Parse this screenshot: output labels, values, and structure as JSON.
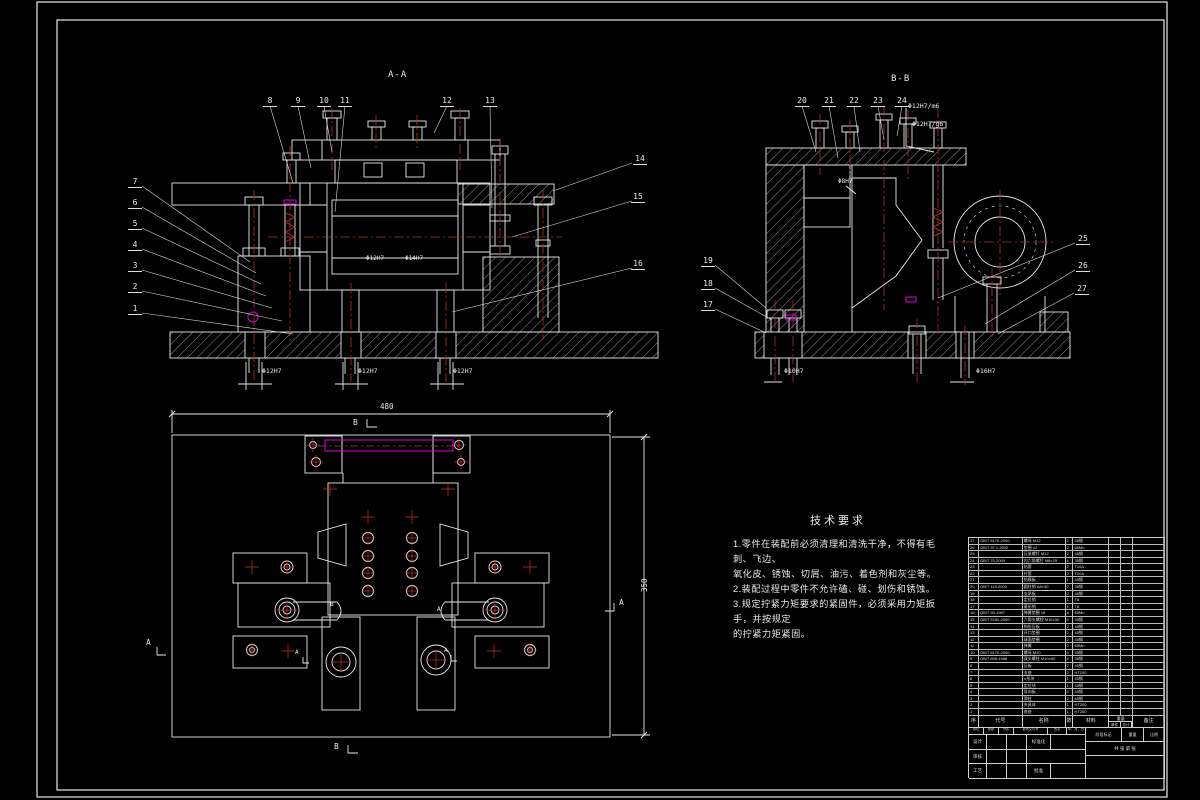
{
  "page": {
    "bg": "#000000",
    "line": "#e8e8e8",
    "centerline_red": "#b03030",
    "highlight_magenta": "#dd00dd"
  },
  "drawing": {
    "section_labels": {
      "front": "A-A",
      "side": "B-B"
    },
    "callouts": {
      "front_top": [
        "8",
        "9",
        "10",
        "11",
        "12",
        "13"
      ],
      "front_left": [
        "7",
        "6",
        "5",
        "4",
        "3",
        "2",
        "1"
      ],
      "front_right": [
        "14",
        "15",
        "16"
      ],
      "side_top": [
        "20",
        "21",
        "22",
        "23",
        "24"
      ],
      "side_left": [
        "19",
        "18",
        "17"
      ],
      "side_right": [
        "25",
        "26",
        "27"
      ]
    },
    "dimensions": {
      "front_mid": [
        "Φ12H7",
        "Φ14H7"
      ],
      "front_bottom": [
        "Φ12H7",
        "Φ12H7",
        "Φ12H7"
      ],
      "side_fit": [
        "Φ12H7/m6",
        "Φ12H7/g6"
      ],
      "side_mid": "Φ8H7",
      "side_bottom": [
        "Φ10H7",
        "Φ16H7"
      ],
      "plan_width": "480",
      "plan_height": "350"
    },
    "view_marks": {
      "plan_top": "B",
      "plan_bottom": "B",
      "plan_left": "A",
      "plan_right": "A",
      "inner_b": "B",
      "inner_a": "A",
      "leg_a_left": "A",
      "leg_a_right": "A"
    }
  },
  "tech_req": {
    "title": "技术要求",
    "lines": [
      "1.零件在装配前必须清理和清洗干净，不得有毛刺、飞边、",
      "氧化皮、锈蚀、切屑、油污、着色剂和灰尘等。",
      "2.装配过程中零件不允许磕、碰、划伤和锈蚀。",
      "3.规定拧紧力矩要求的紧固件，必须采用力矩扳手，并按规定",
      "的拧紧力矩紧固。"
    ]
  },
  "parts_list": {
    "headers": [
      "序号",
      "代号",
      "名称",
      "数量",
      "材料",
      "备注"
    ],
    "weight_header": "重量",
    "weight_sub": [
      "单件",
      "总计"
    ],
    "rows": [
      {
        "no": "27",
        "code": "GB/T 6170-2000",
        "name": "螺母 M12",
        "qty": "2",
        "mat": "35钢"
      },
      {
        "no": "26",
        "code": "GB/T 97.1-2002",
        "name": "垫圈 12",
        "qty": "2",
        "mat": "65Mn"
      },
      {
        "no": "25",
        "code": "",
        "name": "压紧螺钉 M12",
        "qty": "2",
        "mat": "45钢"
      },
      {
        "no": "24",
        "code": "GB/T 70-2000",
        "name": "内六角螺钉 M8×25",
        "qty": "4",
        "mat": "35钢"
      },
      {
        "no": "23",
        "code": "",
        "name": "钻套",
        "qty": "2",
        "mat": "T10A"
      },
      {
        "no": "22",
        "code": "",
        "name": "衬套",
        "qty": "2",
        "mat": "T10A"
      },
      {
        "no": "21",
        "code": "",
        "name": "钻模板",
        "qty": "1",
        "mat": "45钢"
      },
      {
        "no": "20",
        "code": "GB/T 119-2000",
        "name": "圆柱销 A8×30",
        "qty": "2",
        "mat": "35钢"
      },
      {
        "no": "19",
        "code": "",
        "name": "支承板",
        "qty": "2",
        "mat": "45钢"
      },
      {
        "no": "18",
        "code": "",
        "name": "定位销",
        "qty": "1",
        "mat": "T8"
      },
      {
        "no": "17",
        "code": "",
        "name": "菱形销",
        "qty": "1",
        "mat": "T8"
      },
      {
        "no": "16",
        "code": "GB/T 93-1987",
        "name": "弹簧垫圈 16",
        "qty": "4",
        "mat": "65Mn"
      },
      {
        "no": "15",
        "code": "GB/T 5782-2000",
        "name": "六角头螺栓 M16×50",
        "qty": "4",
        "mat": "35钢"
      },
      {
        "no": "14",
        "code": "",
        "name": "钩形压板",
        "qty": "2",
        "mat": "45钢"
      },
      {
        "no": "13",
        "code": "",
        "name": "开口垫圈",
        "qty": "2",
        "mat": "45钢"
      },
      {
        "no": "12",
        "code": "",
        "name": "球面垫圈",
        "qty": "2",
        "mat": "45钢"
      },
      {
        "no": "11",
        "code": "",
        "name": "弹簧",
        "qty": "2",
        "mat": "65Mn"
      },
      {
        "no": "10",
        "code": "GB/T 6170-2000",
        "name": "螺母 M10",
        "qty": "4",
        "mat": "35钢"
      },
      {
        "no": "9",
        "code": "GB/T 898-1988",
        "name": "双头螺柱 M10×60",
        "qty": "4",
        "mat": "35钢"
      },
      {
        "no": "8",
        "code": "",
        "name": "压板",
        "qty": "2",
        "mat": "45钢"
      },
      {
        "no": "7",
        "code": "",
        "name": "支座",
        "qty": "2",
        "mat": "HT200"
      },
      {
        "no": "6",
        "code": "",
        "name": "V形块",
        "qty": "1",
        "mat": "45钢"
      },
      {
        "no": "5",
        "code": "",
        "name": "定位块",
        "qty": "1",
        "mat": "45钢"
      },
      {
        "no": "4",
        "code": "",
        "name": "导向板",
        "qty": "2",
        "mat": "45钢"
      },
      {
        "no": "3",
        "code": "",
        "name": "滑柱",
        "qty": "2",
        "mat": "45钢"
      },
      {
        "no": "2",
        "code": "",
        "name": "夹具体",
        "qty": "1",
        "mat": "HT200"
      },
      {
        "no": "1",
        "code": "",
        "name": "底座",
        "qty": "1",
        "mat": "HT200"
      }
    ]
  },
  "title_block": {
    "row1": [
      "标记",
      "处数",
      "分区",
      "更改文件号",
      "签名",
      "年、月、日"
    ],
    "design": "设计",
    "check": "审核",
    "process": "工艺",
    "standard": "标准化",
    "approve": "批准",
    "stage": "阶段标记",
    "weight": "重量",
    "scale": "比例",
    "sheets": "共 张 第 张"
  }
}
